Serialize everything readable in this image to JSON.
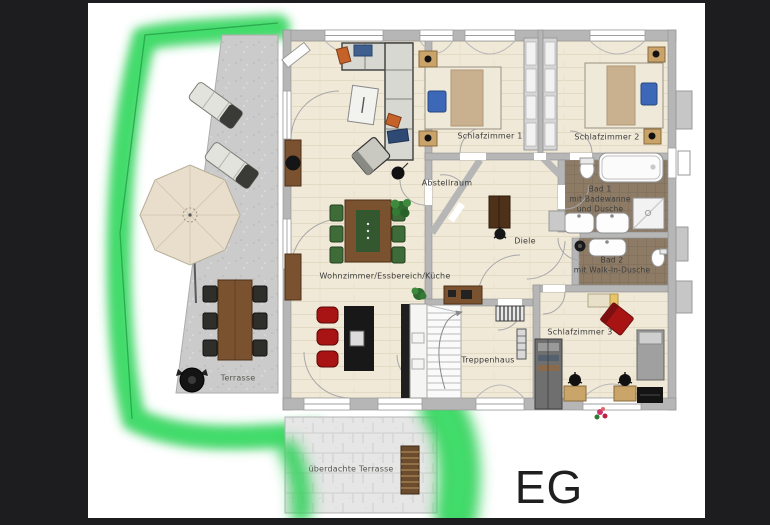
{
  "floor": {
    "label": "EG"
  },
  "rooms": {
    "wohnzimmer": {
      "label": "Wohnzimmer/Essbereich/Küche"
    },
    "schlafzimmer1": {
      "label": "Schlafzimmer 1"
    },
    "schlafzimmer2": {
      "label": "Schlafzimmer 2"
    },
    "schlafzimmer3": {
      "label": "Schlafzimmer 3"
    },
    "bad1": {
      "lines": [
        "Bad 1",
        "mit Badewanne",
        "und Dusche"
      ]
    },
    "bad2": {
      "lines": [
        "Bad 2",
        "mit Walk-In-Dusche"
      ]
    },
    "diele": {
      "label": "Diele"
    },
    "abstellraum": {
      "label": "Abstellraum"
    },
    "treppenhaus": {
      "label": "Treppenhaus"
    },
    "terrasse": {
      "label": "Terrasse"
    },
    "ueberdachte_terrasse": {
      "label": "überdachte Terrasse"
    }
  },
  "palette": {
    "background_black": "#1d1d1f",
    "paper_white": "#ffffff",
    "hedge_green": "#2ed158",
    "hedge_core_green": "#45e070",
    "hedge_line_green": "#27a14b",
    "wall_gray": "#b6b6b6",
    "floor_beige": "#f0e9d8",
    "tile_brown": "#8d7b66",
    "terrace_concrete": "#cbcbcb",
    "stone_pavers": "#e6e6e6",
    "wood_brown": "#7a5230",
    "accent_red": "#a81414",
    "chair_green": "#3f6b39",
    "pillow_blue": "#3d68b8",
    "text_dark": "#3c3c3c"
  }
}
